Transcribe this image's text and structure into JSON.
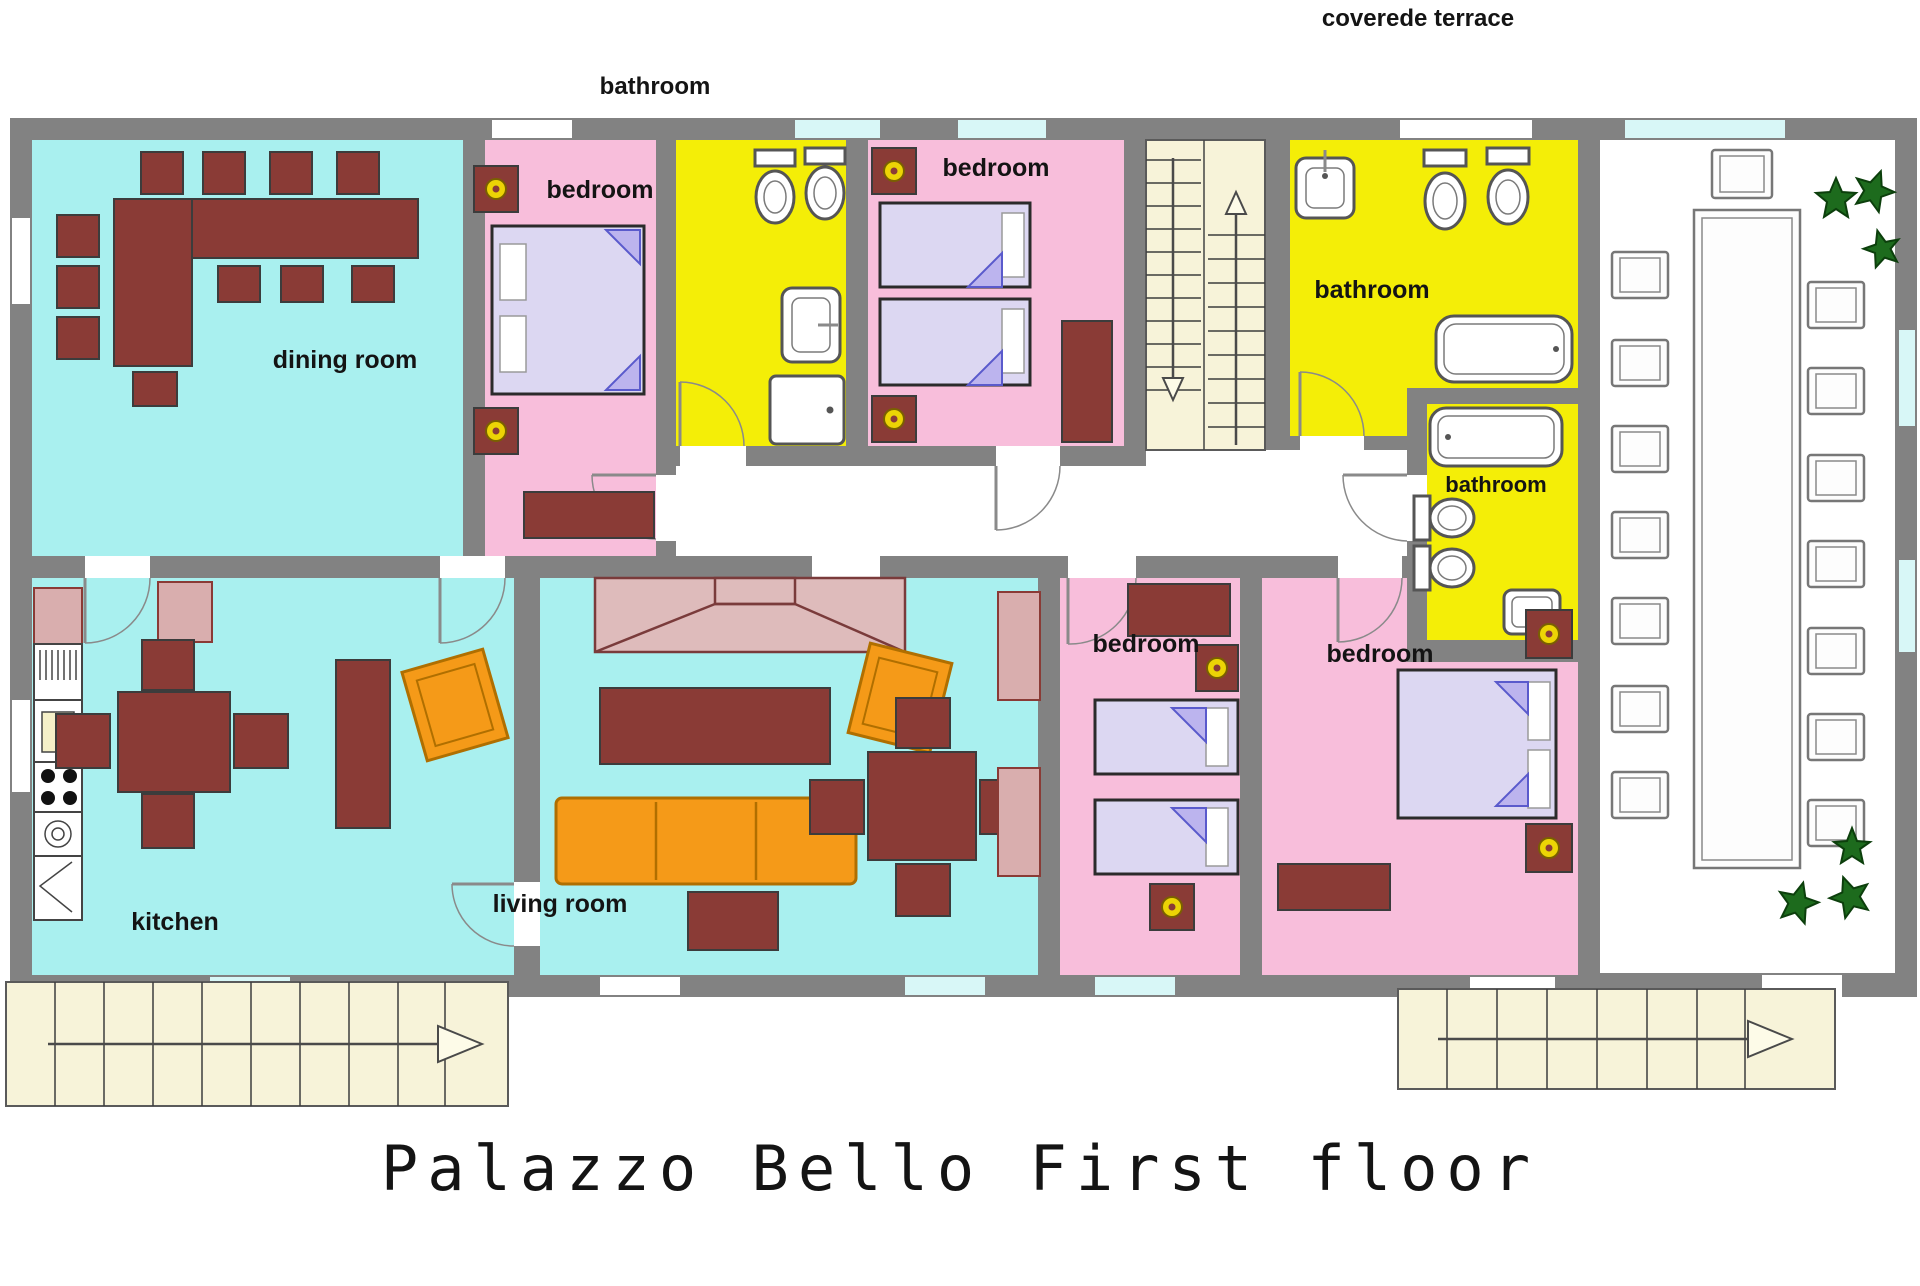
{
  "labels": {
    "covered_terrace": "coverede terrace",
    "bathroom_top": "bathroom",
    "dining": "dining room",
    "bedroom_1": "bedroom",
    "bedroom_2": "bedroom",
    "bathroom_big": "bathroom",
    "bathroom_small": "bathroom",
    "kitchen": "kitchen",
    "living": "living room",
    "bedroom_3": "bedroom",
    "bedroom_4": "bedroom"
  },
  "title": {
    "text": "Palazzo Bello First floor"
  },
  "colors": {
    "wall": "#828282",
    "room_cyan": "#a9f0ef",
    "room_pink": "#f8bedb",
    "room_yellow": "#f4ee07",
    "corridor_white": "#ffffff",
    "terrace_white": "#ffffff",
    "stairs_cream": "#f7f3d9",
    "furniture_dark_red": "#8a3b36",
    "furniture_rose": "#debbbb",
    "sofa_orange": "#f59a18",
    "bed_lavender": "#dcd7f2",
    "plant_green": "#1d6b1d",
    "window_cyan": "#d8f7f7",
    "title_red": "#d4453e"
  },
  "icons": [
    "toilet-icon",
    "bidet-icon",
    "sink-icon",
    "shower-icon",
    "bathtub-icon",
    "bed-icon",
    "lamp-icon",
    "plant-icon",
    "stair-arrow-icon",
    "door-arc-icon",
    "stove-icon",
    "washing-machine-icon",
    "fridge-icon"
  ]
}
